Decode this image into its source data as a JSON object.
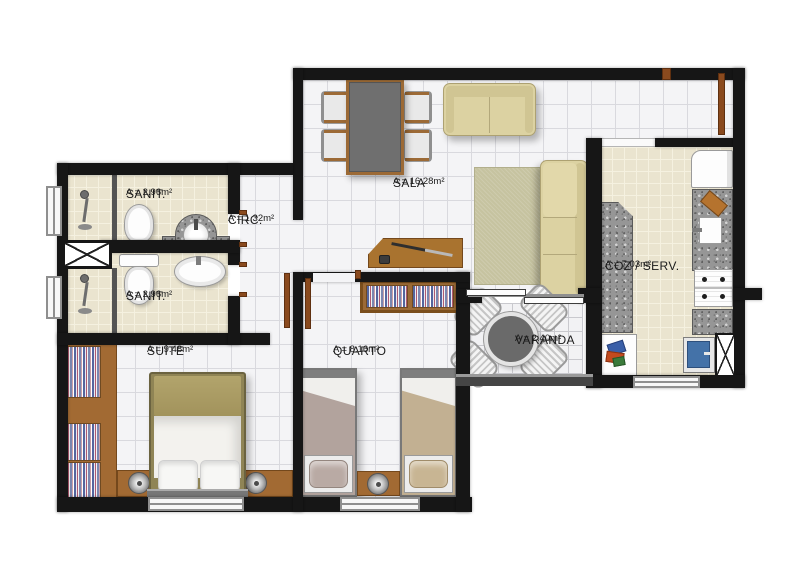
{
  "rooms": {
    "sanit_top": {
      "name": "SANIT.",
      "area": "A = 2.96m²"
    },
    "circ": {
      "name": "CIRC.",
      "area": "A = 1.32m²"
    },
    "sanit_bottom": {
      "name": "SANIT.",
      "area": "A = 2.96m²"
    },
    "sala": {
      "name": "SALA",
      "area": "A = 16.28m²"
    },
    "coz_serv": {
      "name": "COZ / SERV.",
      "area": "A = 7.03m²"
    },
    "varanda": {
      "name": "VARANDA",
      "area": "A = 2.40m²"
    },
    "suite": {
      "name": "SUÍTE",
      "area": "A = 9.48m²"
    },
    "quarto": {
      "name": "QUARTO",
      "area": "A = 8.16m²"
    }
  },
  "colors": {
    "wall": "#161616",
    "wood": "#a26a33",
    "granite": "#969696",
    "white_tile_floor": "#f4f4f6",
    "beige_tile_floor": "#eae4cf",
    "sofa_beige": "#dcd2a2",
    "rug_sage": "#c6c3a0",
    "washer_blue": "#4472a8",
    "door_frame_brown": "#8a4a1e",
    "label_text": "#1b1b1b"
  }
}
